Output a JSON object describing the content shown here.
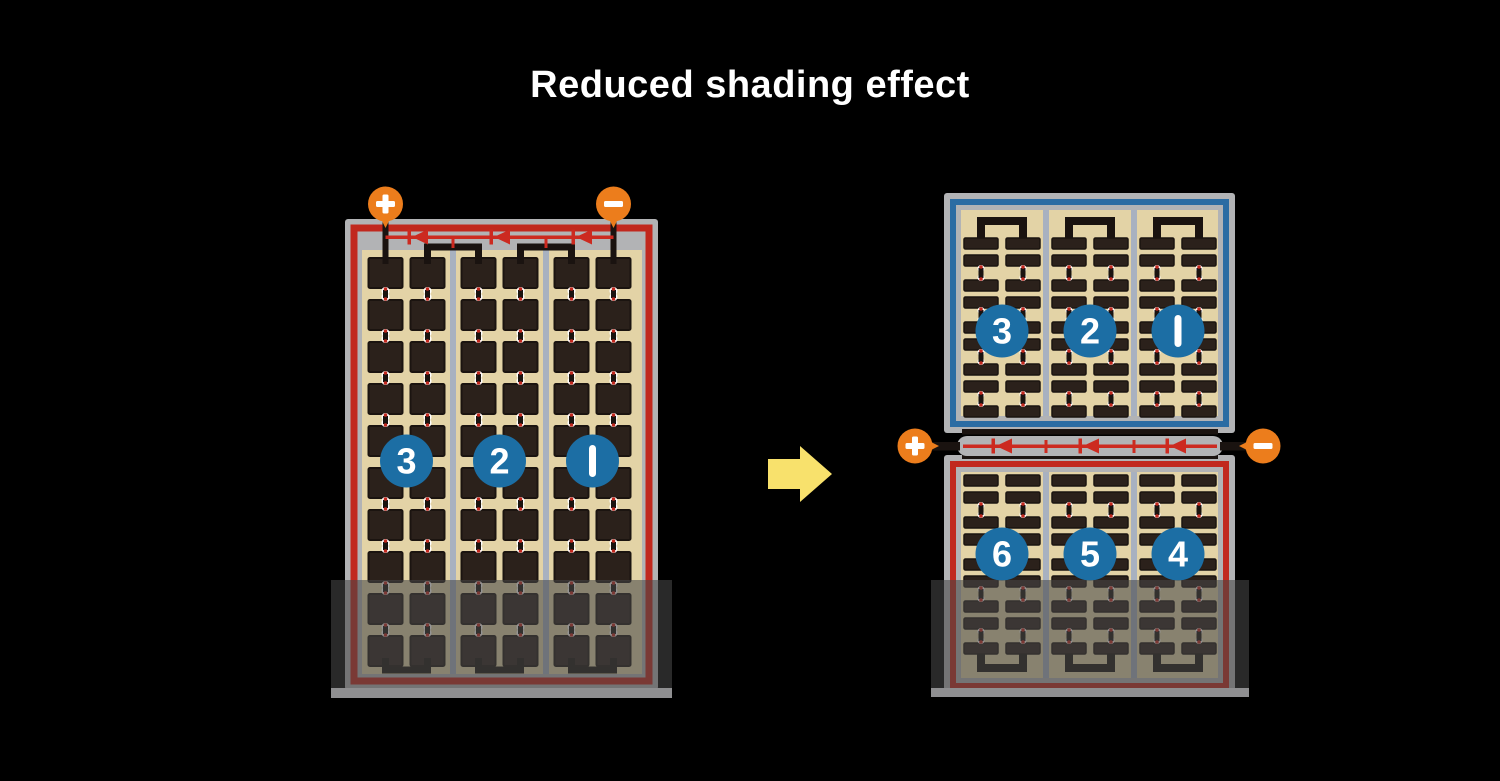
{
  "title": "Reduced shading effect",
  "colors": {
    "background": "#000000",
    "title_text": "#ffffff",
    "frame_gray": "#b2b3b5",
    "frame_bottom_strip": "#8f8f91",
    "panel_tan": "#e3d3a6",
    "cell_dark": "#2b211b",
    "cell_border": "#1b1410",
    "separator_gray": "#a8b1c0",
    "border_red": "#c1281e",
    "border_blue": "#2b6ca3",
    "diode_red": "#cc2a20",
    "wire_black": "#1a1310",
    "terminal_orange": "#ec7d1c",
    "terminal_symbol": "#ffffff",
    "circle_blue": "#1c6ea4",
    "circle_text": "#ffffff",
    "arrow_yellow": "#f8e16c",
    "shade_overlay": "rgba(70,70,70,0.58)",
    "connector_white": "#ffffff",
    "connector_red": "#c1281e"
  },
  "left_panel": {
    "description": "conventional full-cell module, bottom rows shaded",
    "terminals": {
      "positive": "+",
      "negative": "−"
    },
    "string_labels": [
      "3",
      "2",
      "1"
    ],
    "strings": 3,
    "columns_per_string": 2,
    "rows": 10,
    "shaded": true
  },
  "right_top_panel": {
    "description": "upper half of half-cut module, unshaded",
    "string_labels": [
      "3",
      "2",
      "1"
    ],
    "strings": 3,
    "columns_per_string": 2
  },
  "right_bottom_panel": {
    "description": "lower half of half-cut module, bottom rows shaded",
    "string_labels": [
      "6",
      "5",
      "4"
    ],
    "strings": 3,
    "columns_per_string": 2,
    "shaded": true
  },
  "junction": {
    "terminals": {
      "positive": "+",
      "negative": "−"
    },
    "diodes": 3
  },
  "arrow": {
    "direction": "right"
  }
}
